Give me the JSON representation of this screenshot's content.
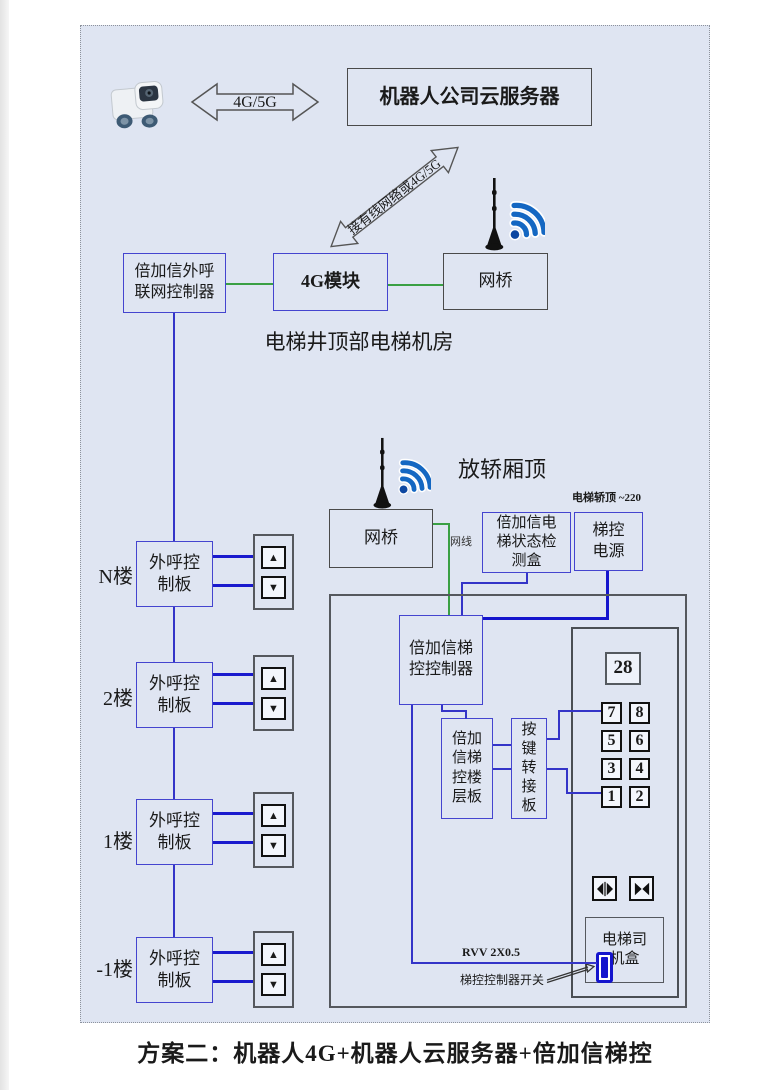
{
  "caption": "方案二：机器人4G+机器人云服务器+倍加信梯控",
  "icons": {
    "up_arrow": "▲",
    "down_arrow": "▼"
  },
  "top": {
    "link_label": "4G/5G",
    "cloud_server_label": "机器人公司云服务器",
    "uplink_label": "接有线网络或4G/5G"
  },
  "machine_room": {
    "section_label": "电梯井顶部电梯机房",
    "outcall_controller_label": "倍加信外呼联网控制器",
    "module_4g_label": "4G模块",
    "bridge_label": "网桥"
  },
  "car_top": {
    "section_label": "放轿厢顶",
    "bridge_label": "网桥",
    "cable_label": "网线",
    "status_box_label": "倍加信电梯状态检测盒",
    "power_label": "梯控电源",
    "power_note": "电梯轿顶 ~220"
  },
  "car": {
    "controller_label": "倍加信梯控控制器",
    "floor_board_label": "倍加信梯控楼层板",
    "key_adapter_label": "按键转接板",
    "display_value": "28",
    "keypad": [
      "7",
      "8",
      "5",
      "6",
      "3",
      "4",
      "1",
      "2"
    ],
    "driver_box_label": "电梯司机盒",
    "wire_label": "RVV 2X0.5",
    "switch_label": "梯控控制器开关"
  },
  "floors": [
    {
      "label": "N楼",
      "board_label": "外呼控制板"
    },
    {
      "label": "2楼",
      "board_label": "外呼控制板"
    },
    {
      "label": "1楼",
      "board_label": "外呼控制板"
    },
    {
      "label": "-1楼",
      "board_label": "外呼控制板"
    }
  ],
  "colors": {
    "diagram_bg": "#dfe5f2",
    "box_border_dark": "#4a4a4a",
    "box_border_blue": "#4444cf",
    "wire_blue": "#3434c8",
    "wire_blue_bold": "#1414cd",
    "wire_green": "#3aa044",
    "wifi_blue": "#1467c2",
    "button_black": "#111111"
  }
}
